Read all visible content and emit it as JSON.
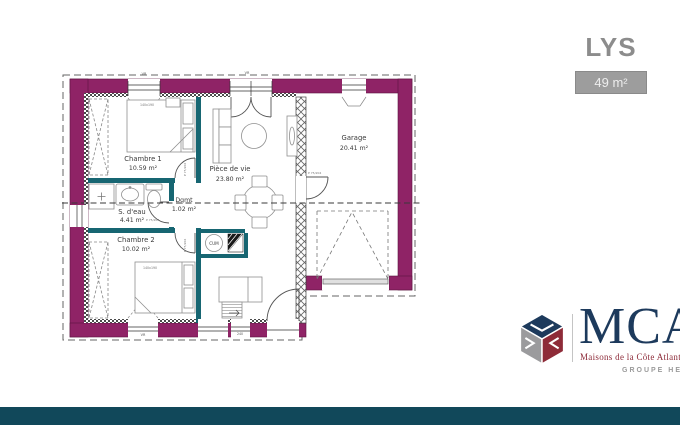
{
  "header": {
    "model_name": "LYS",
    "area_badge": "49 m²"
  },
  "plan": {
    "rooms": {
      "chambre1": {
        "name": "Chambre 1",
        "area": "10.59 m²"
      },
      "sdeau": {
        "name": "S. d'eau",
        "area": "4.41 m²"
      },
      "chambre2": {
        "name": "Chambre 2",
        "area": "10.02 m²"
      },
      "degagement": {
        "name": "Dgmt",
        "area": "1.02 m²"
      },
      "piece_de_vie": {
        "name": "Pièce de vie",
        "area": "23.80 m²"
      },
      "garage": {
        "name": "Garage",
        "area": "20.41 m²"
      }
    },
    "labels": {
      "water_heater": "CUM",
      "bed_size": "140x190",
      "door_size": "P 75/204",
      "roller_shutter": "VR",
      "window_dim": "240"
    },
    "colors": {
      "exterior_wall": "#8f2366",
      "interior_wall": "#176672",
      "footer_bar": "#11485a"
    }
  },
  "branding": {
    "logo_text": "MCA",
    "tagline": "Maisons de la Côte Atlantique",
    "group_label": "GROUPE HEXAOM"
  }
}
